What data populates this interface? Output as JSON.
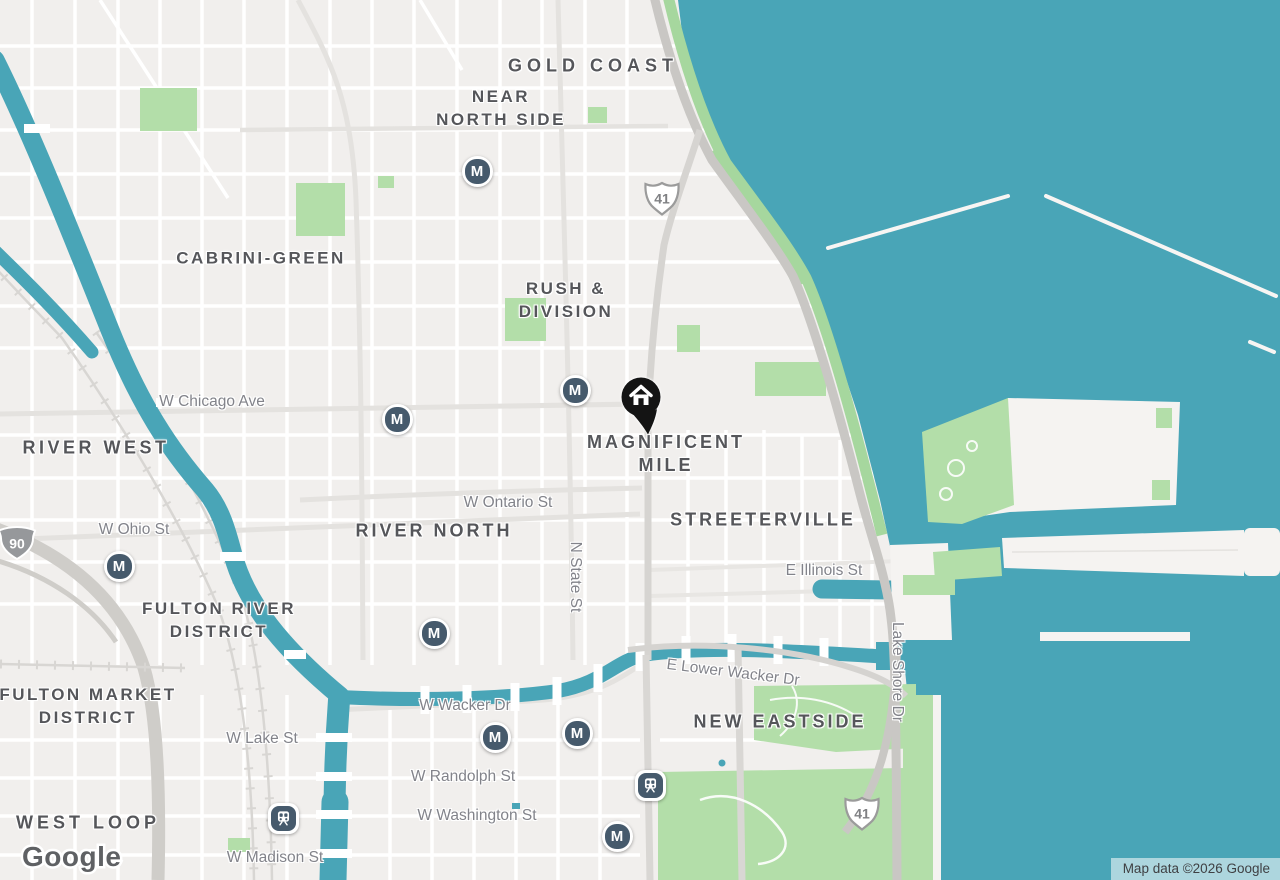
{
  "map": {
    "attribution": "Map data ©2026 Google",
    "logo": "Google"
  },
  "colors": {
    "water": "#49A5B7",
    "land": "#F1EFED",
    "park": "#B3DEA9",
    "transit_marker": "#465A6C",
    "pin": "#141414"
  },
  "neighborhoods": [
    {
      "name": "GOLD COAST",
      "lines": [
        "GOLD COAST"
      ],
      "x": 593,
      "y": 66,
      "size": 18,
      "spacing": 5
    },
    {
      "name": "NEAR NORTH SIDE",
      "lines": [
        "NEAR",
        "NORTH SIDE"
      ],
      "x": 501,
      "y": 108
    },
    {
      "name": "CABRINI-GREEN",
      "lines": [
        "CABRINI-GREEN"
      ],
      "x": 261,
      "y": 258
    },
    {
      "name": "RUSH & DIVISION",
      "lines": [
        "RUSH &",
        "DIVISION"
      ],
      "x": 566,
      "y": 300
    },
    {
      "name": "RIVER WEST",
      "lines": [
        "RIVER WEST"
      ],
      "x": 96,
      "y": 448,
      "size": 18,
      "spacing": 3.5
    },
    {
      "name": "MAGNIFICENT MILE",
      "lines": [
        "MAGNIFICENT",
        "MILE"
      ],
      "x": 666,
      "y": 454,
      "size": 18,
      "spacing": 3
    },
    {
      "name": "RIVER NORTH",
      "lines": [
        "RIVER NORTH"
      ],
      "x": 434,
      "y": 531,
      "size": 18,
      "spacing": 3
    },
    {
      "name": "STREETERVILLE",
      "lines": [
        "STREETERVILLE"
      ],
      "x": 763,
      "y": 520,
      "size": 18,
      "spacing": 3
    },
    {
      "name": "FULTON RIVER DISTRICT",
      "lines": [
        "FULTON RIVER",
        "DISTRICT"
      ],
      "x": 219,
      "y": 620
    },
    {
      "name": "FULTON MARKET DISTRICT",
      "lines": [
        "FULTON MARKET",
        "DISTRICT"
      ],
      "x": 88,
      "y": 706
    },
    {
      "name": "NEW EASTSIDE",
      "lines": [
        "NEW EASTSIDE"
      ],
      "x": 780,
      "y": 722,
      "size": 18,
      "spacing": 3
    },
    {
      "name": "WEST LOOP",
      "lines": [
        "WEST LOOP"
      ],
      "x": 88,
      "y": 823,
      "size": 18,
      "spacing": 4
    }
  ],
  "streets": [
    {
      "name": "W Chicago Ave",
      "x": 212,
      "y": 402,
      "rotate": 0
    },
    {
      "name": "W Ohio St",
      "x": 134,
      "y": 530,
      "rotate": 0
    },
    {
      "name": "W Ontario St",
      "x": 508,
      "y": 503,
      "rotate": 0
    },
    {
      "name": "N State St",
      "x": 575,
      "y": 577,
      "rotate": 90
    },
    {
      "name": "E Illinois St",
      "x": 824,
      "y": 571,
      "rotate": 0
    },
    {
      "name": "Lake Shore Dr",
      "x": 897,
      "y": 672,
      "rotate": 90
    },
    {
      "name": "E Lower Wacker Dr",
      "x": 733,
      "y": 673,
      "rotate": 7
    },
    {
      "name": "W Wacker Dr",
      "x": 465,
      "y": 706,
      "rotate": 0
    },
    {
      "name": "W Lake St",
      "x": 262,
      "y": 739,
      "rotate": 0
    },
    {
      "name": "W Randolph St",
      "x": 463,
      "y": 777,
      "rotate": 0
    },
    {
      "name": "W Washington St",
      "x": 477,
      "y": 816,
      "rotate": 0
    },
    {
      "name": "W Madison St",
      "x": 275,
      "y": 858,
      "rotate": 0
    }
  ],
  "highway_shields": [
    {
      "type": "us",
      "number": "41",
      "x": 662,
      "y": 201
    },
    {
      "type": "us",
      "number": "41",
      "x": 862,
      "y": 816
    },
    {
      "type": "interstate",
      "number": "90",
      "x": 17,
      "y": 546
    }
  ],
  "transit": {
    "metro_label": "M",
    "metro": [
      {
        "x": 477,
        "y": 171
      },
      {
        "x": 397,
        "y": 419
      },
      {
        "x": 575,
        "y": 390
      },
      {
        "x": 119,
        "y": 566
      },
      {
        "x": 434,
        "y": 633
      },
      {
        "x": 495,
        "y": 737
      },
      {
        "x": 577,
        "y": 733
      },
      {
        "x": 617,
        "y": 836
      }
    ],
    "rail": [
      {
        "x": 650,
        "y": 785
      },
      {
        "x": 283,
        "y": 818
      }
    ]
  },
  "pin": {
    "type": "home",
    "icon": "home-icon",
    "x": 641,
    "y": 397
  }
}
